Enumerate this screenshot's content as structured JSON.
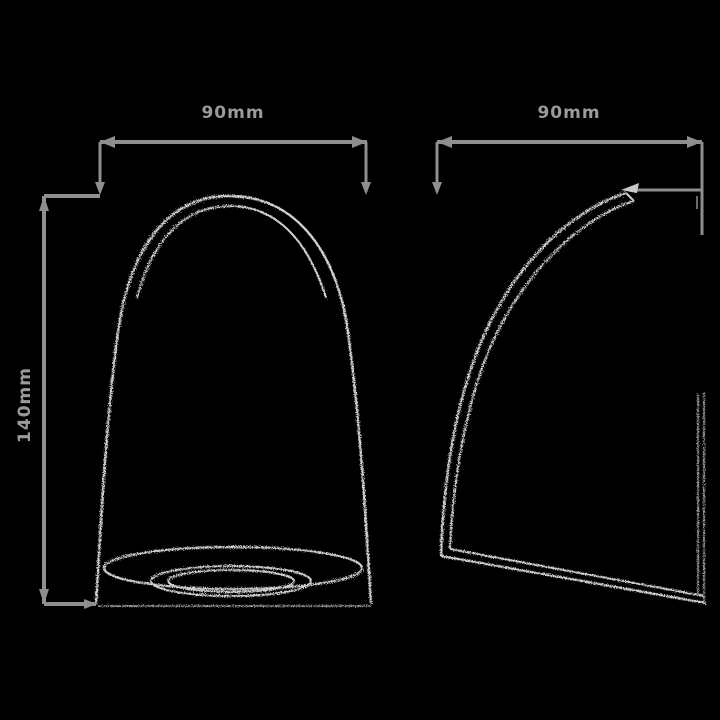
{
  "drawing": {
    "description": "technical drawing, two orthographic views of a bell-shaped shade",
    "colors": {
      "background": "#000000",
      "dimension_line": "#8e8e8e",
      "object_outline": "#cfcfcf",
      "label_text": "#9a9a9a"
    },
    "views": {
      "front": {
        "width_dimension": "90mm",
        "height_dimension": "140mm"
      },
      "side": {
        "width_dimension": "90mm"
      }
    }
  }
}
